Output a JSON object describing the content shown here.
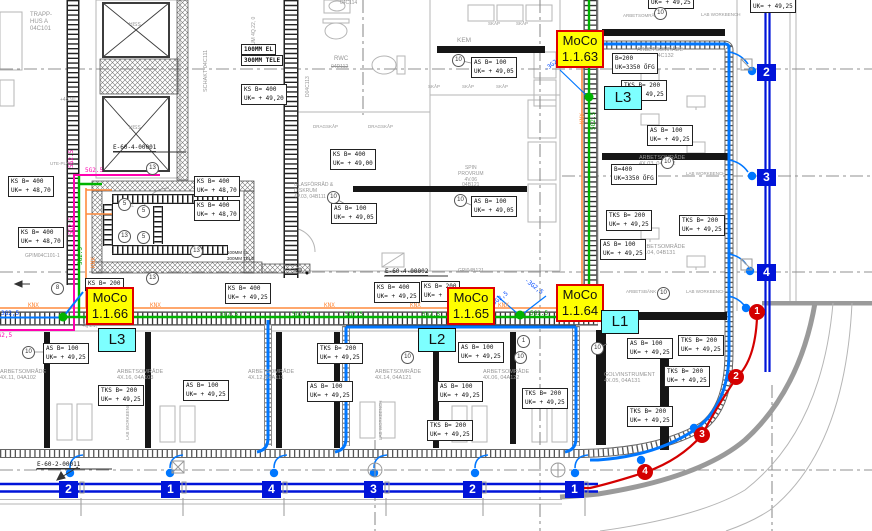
{
  "moco": {
    "m63": {
      "name": "MoCo",
      "id": "1.1.63"
    },
    "m64": {
      "name": "MoCo",
      "id": "1.1.64"
    },
    "m65": {
      "name": "MoCo",
      "id": "1.1.65"
    },
    "m66": {
      "name": "MoCo",
      "id": "1.1.66"
    }
  },
  "lx": {
    "l1": "L1",
    "l2": "L2",
    "l3": "L3"
  },
  "mb": {
    "ks400_4920": {
      "a": "KS B= 400",
      "b": "UK= + 49,20"
    },
    "ks400_4870": {
      "a": "KS B= 400",
      "b": "UK= + 48,70"
    },
    "ks400_4900": {
      "a": "KS B= 400",
      "b": "UK= + 49,00"
    },
    "ks400_4925": {
      "a": "KS B= 400",
      "b": "UK= + 49,25"
    },
    "as100_4905": {
      "a": "AS B= 100",
      "b": "UK= + 49,05"
    },
    "as100_4925": {
      "a": "AS B= 100",
      "b": "UK= + 49,25"
    },
    "tks200_4925": {
      "a": "TKS B= 200",
      "b": "UK= + 49,25"
    },
    "ks200_part": {
      "a": "KS B= 200",
      "b": "UK= +"
    },
    "ks200": {
      "a": "KS B= 200",
      "b": ""
    },
    "b200": {
      "a": "B=200",
      "b": "UK=3350 ÖFG"
    },
    "b400": {
      "a": "B=400",
      "b": "UK=3350 ÖFG"
    }
  },
  "cables": {
    "g": "5G2.5",
    "knx": "KNX",
    "bd": "-3G2,5",
    "t3": "3G2,5"
  },
  "markers": {
    "n1": "1",
    "n2": "2",
    "n3": "3",
    "n4": "4"
  },
  "refs": {
    "r1": "1",
    "r5": "5",
    "r8": "8",
    "r10": "10",
    "r13": "13"
  },
  "eq": {
    "e1": "E-60-4-00001",
    "e2": "E-60-4-00002",
    "e3": "E-60-2-00011",
    "gpim": "GPIM04C101-1",
    "gpi": "GPI04B121"
  },
  "ducts": {
    "el": "100MM EL",
    "tele": "300MM TELE"
  },
  "rooms": {
    "trapp1": "TRAPP-",
    "trapp2": "HUS A",
    "trapp3": "04C101",
    "hiss": "HISS",
    "schakt": "SCHAKT",
    "schaktid": "04C111",
    "kapprum": "KAPPRUM",
    "kapprumid": "4Q.22, 0",
    "rwc": "RWC",
    "rwcid": "04D112",
    "d113": "D04C113",
    "c114": "04C114",
    "kem": "KEM",
    "spin": "SPIN",
    "provrum": "PROVRUM",
    "spinid1": "4V.06",
    "spinid2": "04B121",
    "glas1": "GLASFÖRRÅD &",
    "glas2": "DISKRUM",
    "glas3": "4V.03, 04B111",
    "el": "EL",
    "ute": "UTE-PLATS",
    "q21": "4Q.21,",
    "golv": "GOLVINSTRUMENT",
    "golvid": "4X.05, 04A131",
    "arb": "ARBETSOMRÅDE",
    "r02": "4X.02, 04C132",
    "r03": "4X.03, 04B132",
    "r04": "4X.04, 04B131",
    "r11": "4X.11, 04A102",
    "r16": "4X.16, 04A103",
    "r12": "4X.12, 04A111",
    "r14": "4X.14, 04A121",
    "r06": "4X.06, 04A122",
    "skap": "SKÅP",
    "drag": "DRAGSKÅP",
    "lab": "LAB WORKBENCH",
    "bank": "ARBETSBÄNK",
    "so": "SÖ",
    "lvl": "+48,90"
  },
  "colors": {
    "tray_green": "#00b400",
    "knx_orange": "#ff8c3f",
    "circuit_magenta": "#ff00b0",
    "supply_blue": "#0077ff",
    "riser_blue": "#0014d9",
    "alarm_red": "#d40000",
    "moco_yellow": "#ffff00",
    "moco_border": "#e00000",
    "load_cyan": "#7dffff"
  }
}
